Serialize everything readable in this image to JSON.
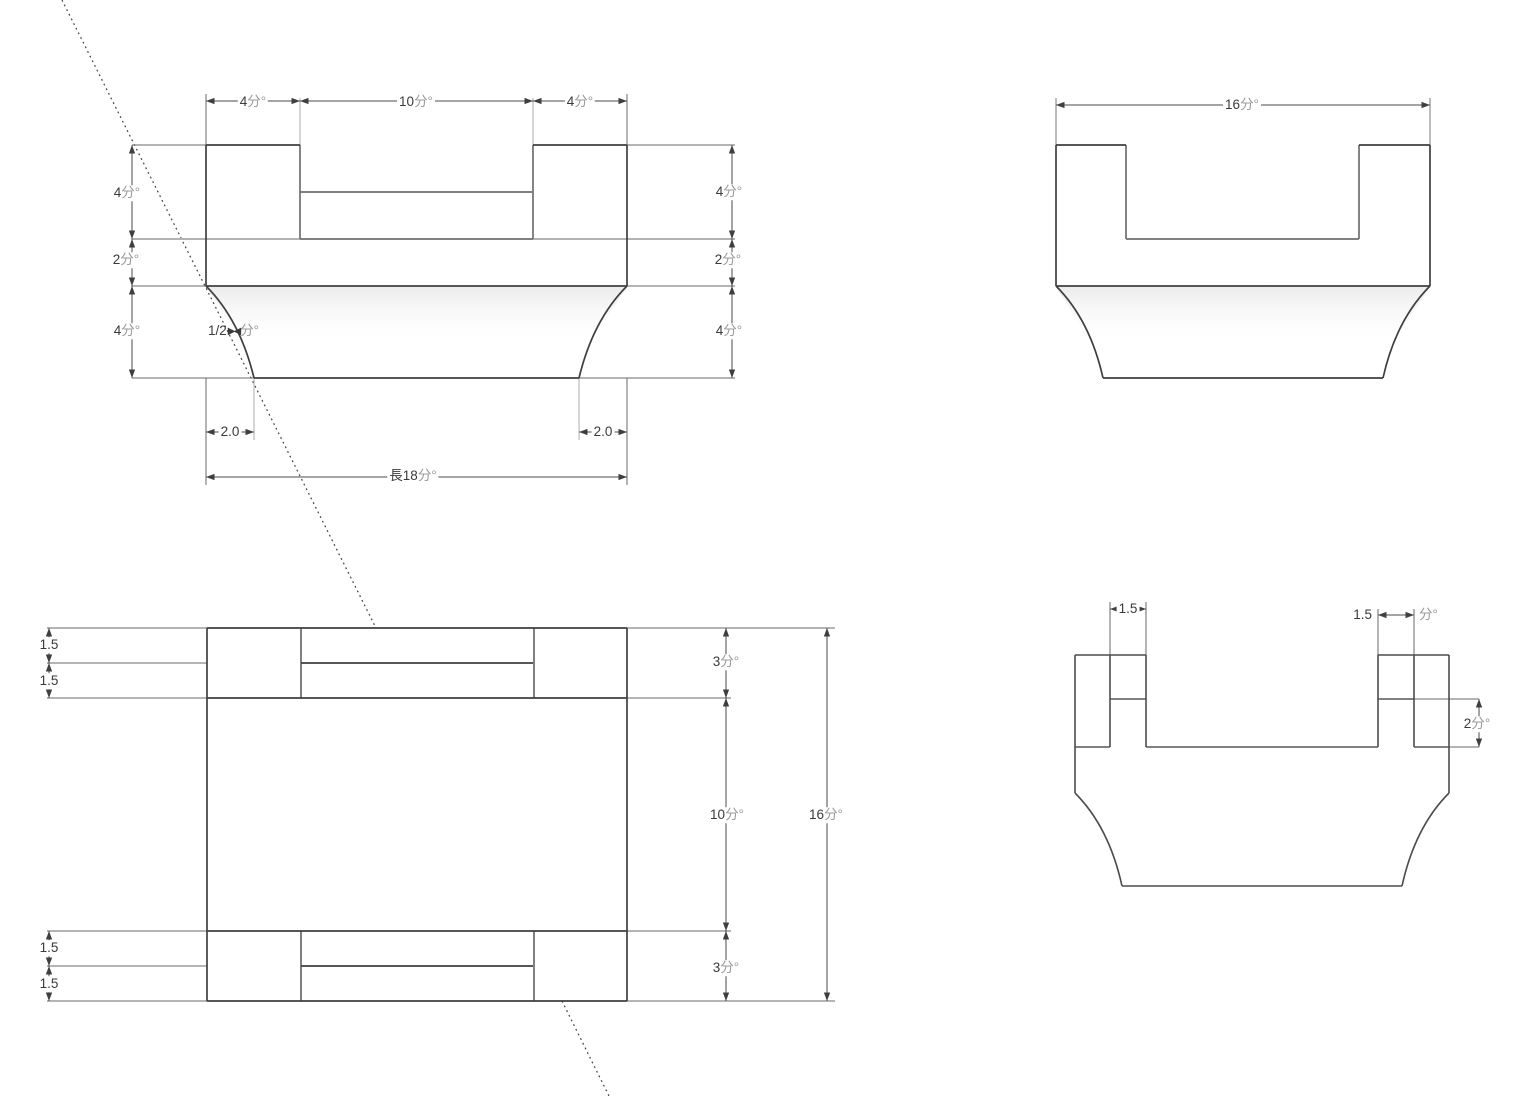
{
  "drawing": {
    "kind": "cad-multiview-part-drawing",
    "unit_suffix": "分°"
  },
  "colors": {
    "outline": "#3f3f3f",
    "gray_edge": "#808080",
    "light_ext": "#b2b2b2",
    "dim_line": "#4a4a4a",
    "text": "#3a3a3a",
    "unit_text": "#9a9a9a",
    "shade_top": "#ebebeb",
    "background": "#ffffff"
  },
  "front": {
    "top_dims": [
      {
        "v": "4",
        "u": "分°"
      },
      {
        "v": "10",
        "u": "分°"
      },
      {
        "v": "4",
        "u": "分°"
      }
    ],
    "left_dims": [
      {
        "v": "4",
        "u": "分°"
      },
      {
        "v": "2",
        "u": "分°"
      },
      {
        "v": "4",
        "u": "分°"
      }
    ],
    "right_dims": [
      {
        "v": "4",
        "u": "分°"
      },
      {
        "v": "2",
        "u": "分°"
      },
      {
        "v": "4",
        "u": "分°"
      }
    ],
    "radius": {
      "v": "1/2",
      "u": "分°"
    },
    "inset_left": "2.0",
    "inset_right": "2.0",
    "length": {
      "v": "長18",
      "u": "分°"
    }
  },
  "side_top": {
    "width": {
      "v": "16",
      "u": "分°"
    }
  },
  "plan": {
    "left_steps": [
      "1.5",
      "1.5",
      "1.5",
      "1.5"
    ],
    "right_dims": [
      {
        "v": "3",
        "u": "分°"
      },
      {
        "v": "10",
        "u": "分°"
      },
      {
        "v": "3",
        "u": "分°"
      }
    ],
    "total_height": {
      "v": "16",
      "u": "分°"
    }
  },
  "side_bottom": {
    "notch_left": "1.5",
    "notch_right_v": "1.5",
    "notch_right_u": "分°",
    "depth": {
      "v": "2",
      "u": "分°"
    }
  }
}
